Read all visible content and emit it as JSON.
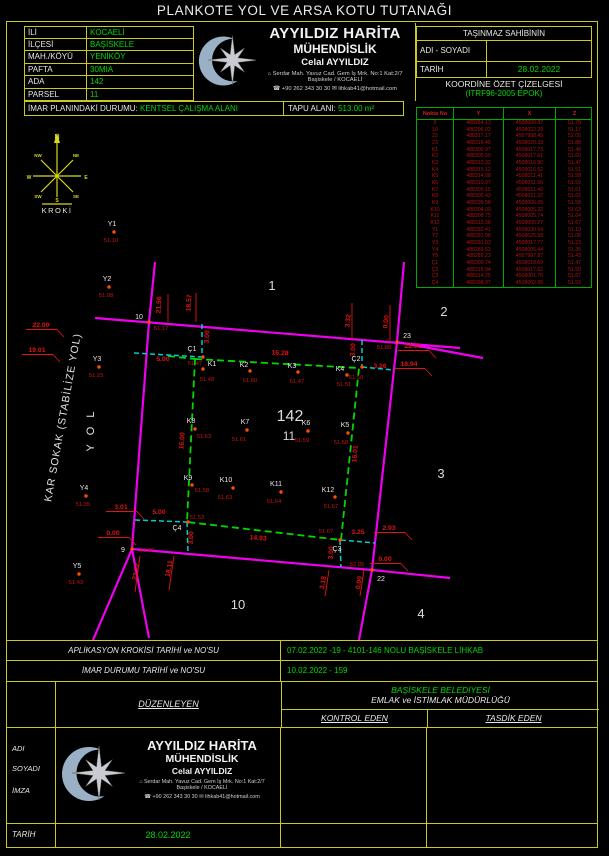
{
  "title": "PLANKOTE YOL VE ARSA KOTU TUTANAĞI",
  "parcel_info": {
    "rows": [
      {
        "label": "İLİ",
        "value": "KOCAELİ"
      },
      {
        "label": "İLÇESİ",
        "value": "BAŞİSKELE"
      },
      {
        "label": "MAH./KÖYÜ",
        "value": "YENİKÖY"
      },
      {
        "label": "PAFTA",
        "value": "30MIA"
      },
      {
        "label": "ADA",
        "value": "142"
      },
      {
        "label": "PARSEL",
        "value": "11"
      }
    ]
  },
  "company": {
    "line1": "AYYILDIZ HARİTA",
    "line2": "MÜHENDİSLİK",
    "line3": "Celal AYYILDIZ",
    "address1": "Serdar Mah. Yavuz Cad. Gem İş Mrk. No:1 Kat:2/7",
    "address2": "Başiskele / KOCAELİ",
    "phone": "+90 262 343 30 30",
    "email": "lihkab41@hotmail.com",
    "address_icon": "⌂",
    "phone_icon": "☎",
    "email_icon": "✉"
  },
  "owner_box": {
    "header": "TAŞINMAZ SAHİBİNİN",
    "name_label": "ADI - SOYADI",
    "name_value": "",
    "date_label": "TARİH",
    "date_value": "28.02.2022"
  },
  "imar": {
    "label": "İMAR PLANINDAKİ DURUMU:",
    "value": "KENTSEL ÇALIŞMA ALANI",
    "tapu_label": "TAPU ALANI:",
    "tapu_value": "513.00 m²"
  },
  "coord_table": {
    "title": "KOORDİNE ÖZET ÇİZELGESİ",
    "subtitle": "(ITRF96-2005 EPOK)",
    "headers": [
      "Nokta  No",
      "Y",
      "X",
      "Z"
    ],
    "rows": [
      [
        "9",
        "488284.13",
        "4508000.37",
        "51.78"
      ],
      [
        "10",
        "488296.02",
        "4508022.29",
        "51.17"
      ],
      [
        "22",
        "488317.17",
        "4507998.45",
        "52.05"
      ],
      [
        "23",
        "488319.49",
        "4508020.33",
        "51.88"
      ],
      [
        "K1",
        "488300.97",
        "4508017.73",
        "51.48"
      ],
      [
        "K2",
        "488305.60",
        "4508017.61",
        "51.60"
      ],
      [
        "K3",
        "488310.32",
        "4508016.80",
        "51.47"
      ],
      [
        "K4",
        "488315.12",
        "4508016.62",
        "51.51"
      ],
      [
        "K5",
        "488314.88",
        "4508011.41",
        "51.58"
      ],
      [
        "K6",
        "488310.97",
        "4508011.56",
        "51.59"
      ],
      [
        "K7",
        "488305.15",
        "4508011.49",
        "51.61"
      ],
      [
        "K8",
        "488300.43",
        "4508011.32",
        "51.63"
      ],
      [
        "K9",
        "488299.98",
        "4508006.05",
        "51.58"
      ],
      [
        "K10",
        "488304.09",
        "4508005.22",
        "51.63"
      ],
      [
        "K11",
        "488308.75",
        "4508005.74",
        "51.64"
      ],
      [
        "K12",
        "488313.38",
        "4508005.27",
        "51.67"
      ],
      [
        "Y1",
        "488292.41",
        "4508030.64",
        "51.10"
      ],
      [
        "Y2",
        "488291.98",
        "4508025.58",
        "51.08"
      ],
      [
        "Y3",
        "488291.03",
        "4508017.77",
        "51.23"
      ],
      [
        "Y4",
        "488289.62",
        "4508005.44",
        "51.35"
      ],
      [
        "Y5",
        "488289.23",
        "4507997.87",
        "51.43"
      ],
      [
        "Ç1",
        "488300.74",
        "4508018.69",
        "51.47"
      ],
      [
        "Ç2",
        "488315.94",
        "4508017.62",
        "51.50"
      ],
      [
        "Ç3",
        "488314.25",
        "4508001.70",
        "51.67"
      ],
      [
        "Ç4",
        "488298.37",
        "4508002.95",
        "51.53"
      ]
    ]
  },
  "map": {
    "colors": {
      "road": "#ee00ee",
      "boundary": "#00d800",
      "offset": "#00cccc",
      "dim": "#e01515",
      "point": "#ff4d00",
      "point_label": "#e8e8e8",
      "elev": "#c81414",
      "compass": "#d8d820"
    },
    "street1": "KAR SOKAK (STABİLİZE YOL)",
    "street2": "Y O L",
    "roads": [
      [
        [
          95,
          318
        ],
        [
          460,
          348
        ]
      ],
      [
        [
          397,
          342
        ],
        [
          483,
          358
        ]
      ],
      [
        [
          155,
          262
        ],
        [
          149,
          322
        ],
        [
          132,
          549
        ],
        [
          93,
          640
        ]
      ],
      [
        [
          404,
          262
        ],
        [
          397,
          342
        ],
        [
          372,
          570
        ],
        [
          359,
          640
        ]
      ],
      [
        [
          132,
          549
        ],
        [
          372,
          570
        ],
        [
          450,
          578
        ]
      ],
      [
        [
          132,
          549
        ],
        [
          149,
          638
        ]
      ]
    ],
    "boundary": [
      [
        195,
        359
      ],
      [
        359,
        368
      ],
      [
        341,
        540
      ],
      [
        187,
        522
      ]
    ],
    "boundary_ext": [
      [
        168,
        356
      ],
      [
        195,
        359
      ]
    ],
    "offsets": [
      [
        [
          134,
          353
        ],
        [
          202,
          357
        ]
      ],
      [
        [
          202,
          324
        ],
        [
          202,
          357
        ]
      ],
      [
        [
          362,
          340
        ],
        [
          362,
          367
        ]
      ],
      [
        [
          362,
          367
        ],
        [
          394,
          370
        ]
      ],
      [
        [
          340,
          540
        ],
        [
          341,
          567
        ]
      ],
      [
        [
          341,
          540
        ],
        [
          375,
          543
        ]
      ],
      [
        [
          135,
          520
        ],
        [
          187,
          522
        ]
      ],
      [
        [
          187,
          522
        ],
        [
          188,
          553
        ]
      ]
    ],
    "leaders": [
      [
        168,
        294,
        168,
        322
      ],
      [
        196,
        293,
        196,
        322
      ],
      [
        352,
        303,
        352,
        341
      ],
      [
        390,
        305,
        390,
        342
      ],
      [
        140,
        556,
        135,
        592
      ],
      [
        174,
        556,
        169,
        590
      ],
      [
        329,
        570,
        325,
        596
      ],
      [
        364,
        570,
        360,
        596
      ]
    ],
    "dims": [
      {
        "t": "22.00",
        "x": 41,
        "y": 327,
        "r": 0,
        "u": 1
      },
      {
        "t": "19.01",
        "x": 37,
        "y": 352,
        "r": 0,
        "u": 1
      },
      {
        "t": "21.56",
        "x": 161,
        "y": 305,
        "r": -87
      },
      {
        "t": "18.57",
        "x": 191,
        "y": 303,
        "r": -87
      },
      {
        "t": "3.00",
        "x": 209,
        "y": 337,
        "r": -87
      },
      {
        "t": "5.00",
        "x": 163,
        "y": 361,
        "r": 0
      },
      {
        "t": "16.28",
        "x": 280,
        "y": 355,
        "r": 3
      },
      {
        "t": "3.32",
        "x": 350,
        "y": 321,
        "r": -85
      },
      {
        "t": "0.00",
        "x": 388,
        "y": 322,
        "r": -85
      },
      {
        "t": "22.01",
        "x": 413,
        "y": 348,
        "r": 0,
        "u": 1
      },
      {
        "t": "18.94",
        "x": 409,
        "y": 366,
        "r": 0,
        "u": 1
      },
      {
        "t": "3.26",
        "x": 380,
        "y": 368,
        "r": 0
      },
      {
        "t": "3.00",
        "x": 355,
        "y": 350,
        "r": -87
      },
      {
        "t": "16.00",
        "x": 184,
        "y": 441,
        "r": -85
      },
      {
        "t": "16.01",
        "x": 357,
        "y": 454,
        "r": -85
      },
      {
        "t": "3.01",
        "x": 121,
        "y": 509,
        "r": 0,
        "u": 1
      },
      {
        "t": "5.00",
        "x": 159,
        "y": 514,
        "r": 0
      },
      {
        "t": "0.00",
        "x": 113,
        "y": 535,
        "r": 0,
        "u": 1
      },
      {
        "t": "3.00",
        "x": 193,
        "y": 538,
        "r": -87
      },
      {
        "t": "14.93",
        "x": 258,
        "y": 540,
        "r": 4
      },
      {
        "t": "3.25",
        "x": 358,
        "y": 534,
        "r": 0
      },
      {
        "t": "2.93",
        "x": 389,
        "y": 530,
        "r": 0,
        "u": 1
      },
      {
        "t": "3.00",
        "x": 333,
        "y": 553,
        "r": -87
      },
      {
        "t": "23.12",
        "x": 138,
        "y": 572,
        "r": -80
      },
      {
        "t": "18.11",
        "x": 171,
        "y": 569,
        "r": -80
      },
      {
        "t": "3.18",
        "x": 325,
        "y": 583,
        "r": -80
      },
      {
        "t": "0.00",
        "x": 361,
        "y": 583,
        "r": -80
      },
      {
        "t": "0.00",
        "x": 385,
        "y": 561,
        "r": 0,
        "u": 1
      }
    ],
    "points": [
      {
        "n": "9",
        "x": 132,
        "y": 549,
        "nx": 123,
        "ny": 552,
        "z": "51.78",
        "zx": 147,
        "zy": 552
      },
      {
        "n": "10",
        "x": 149,
        "y": 322,
        "nx": 139,
        "ny": 319,
        "z": "51.17",
        "zx": 161,
        "zy": 330
      },
      {
        "n": "22",
        "x": 372,
        "y": 570,
        "nx": 381,
        "ny": 581,
        "z": "52.05",
        "zx": 357,
        "zy": 566
      },
      {
        "n": "23",
        "x": 397,
        "y": 342,
        "nx": 407,
        "ny": 338,
        "z": "51.88",
        "zx": 384,
        "zy": 349
      },
      {
        "n": "K1",
        "x": 203,
        "y": 369,
        "nx": 212,
        "ny": 366,
        "z": "51.48",
        "zx": 207,
        "zy": 381
      },
      {
        "n": "K2",
        "x": 250,
        "y": 371,
        "nx": 244,
        "ny": 367,
        "z": "51.60",
        "zx": 250,
        "zy": 382
      },
      {
        "n": "K3",
        "x": 298,
        "y": 372,
        "nx": 292,
        "ny": 368,
        "z": "51.47",
        "zx": 297,
        "zy": 383
      },
      {
        "n": "K4",
        "x": 347,
        "y": 375,
        "nx": 340,
        "ny": 371,
        "z": "51.51",
        "zx": 344,
        "zy": 386
      },
      {
        "n": "K5",
        "x": 348,
        "y": 433,
        "nx": 345,
        "ny": 427,
        "z": "51.58",
        "zx": 341,
        "zy": 444
      },
      {
        "n": "K6",
        "x": 308,
        "y": 431,
        "nx": 306,
        "ny": 425,
        "z": "51.59",
        "zx": 302,
        "zy": 442
      },
      {
        "n": "K7",
        "x": 247,
        "y": 430,
        "nx": 245,
        "ny": 424,
        "z": "51.61",
        "zx": 239,
        "zy": 441
      },
      {
        "n": "K8",
        "x": 195,
        "y": 429,
        "nx": 191,
        "ny": 423,
        "z": "51.63",
        "zx": 204,
        "zy": 438
      },
      {
        "n": "K9",
        "x": 192,
        "y": 485,
        "nx": 188,
        "ny": 480,
        "z": "51.58",
        "zx": 202,
        "zy": 492
      },
      {
        "n": "K10",
        "x": 233,
        "y": 488,
        "nx": 226,
        "ny": 482,
        "z": "51.63",
        "zx": 225,
        "zy": 499
      },
      {
        "n": "K11",
        "x": 281,
        "y": 492,
        "nx": 276,
        "ny": 486,
        "z": "51.64",
        "zx": 274,
        "zy": 503
      },
      {
        "n": "K12",
        "x": 335,
        "y": 497,
        "nx": 328,
        "ny": 492,
        "z": "51.67",
        "zx": 331,
        "zy": 508
      },
      {
        "n": "Y1",
        "x": 114,
        "y": 232,
        "nx": 112,
        "ny": 226,
        "z": "51.10",
        "zx": 111,
        "zy": 242
      },
      {
        "n": "Y2",
        "x": 109,
        "y": 287,
        "nx": 107,
        "ny": 281,
        "z": "51.08",
        "zx": 106,
        "zy": 297
      },
      {
        "n": "Y3",
        "x": 99,
        "y": 367,
        "nx": 97,
        "ny": 361,
        "z": "51.23",
        "zx": 96,
        "zy": 377
      },
      {
        "n": "Y4",
        "x": 86,
        "y": 496,
        "nx": 84,
        "ny": 490,
        "z": "51.35",
        "zx": 83,
        "zy": 506
      },
      {
        "n": "Y5",
        "x": 79,
        "y": 574,
        "nx": 77,
        "ny": 568,
        "z": "51.43",
        "zx": 76,
        "zy": 584
      },
      {
        "n": "Ç1",
        "x": 203,
        "y": 357,
        "nx": 192,
        "ny": 351,
        "z": "51.47",
        "zx": 195,
        "zy": 365
      },
      {
        "n": "Ç2",
        "x": 362,
        "y": 367,
        "nx": 356,
        "ny": 361,
        "z": "51.50",
        "zx": 356,
        "zy": 379
      },
      {
        "n": "Ç3",
        "x": 340,
        "y": 540,
        "nx": 337,
        "ny": 551,
        "z": "51.67",
        "zx": 326,
        "zy": 533
      },
      {
        "n": "Ç4",
        "x": 188,
        "y": 522,
        "nx": 177,
        "ny": 530,
        "z": "51.53",
        "zx": 197,
        "zy": 519
      }
    ],
    "area_labels": [
      {
        "t": "1",
        "x": 272,
        "y": 290,
        "s": 13
      },
      {
        "t": "2",
        "x": 444,
        "y": 316,
        "s": 13
      },
      {
        "t": "3",
        "x": 441,
        "y": 478,
        "s": 13
      },
      {
        "t": "4",
        "x": 421,
        "y": 618,
        "s": 13
      },
      {
        "t": "10",
        "x": 238,
        "y": 609,
        "s": 13
      },
      {
        "t": "142",
        "x": 290,
        "y": 421,
        "s": 16
      },
      {
        "t": "11",
        "x": 289,
        "y": 440,
        "s": 12
      }
    ],
    "compass": {
      "lines": [
        [
          57,
          142,
          57,
          197
        ],
        [
          33,
          176,
          81,
          176
        ],
        [
          41,
          160,
          73,
          192
        ],
        [
          73,
          160,
          41,
          192
        ],
        [
          42,
          204,
          72,
          204
        ]
      ],
      "arrow": "57,133 54,143 60,143",
      "letters": [
        {
          "t": "N",
          "x": 57,
          "y": 139,
          "s": 7
        },
        {
          "t": "S",
          "x": 57,
          "y": 202,
          "s": 5
        },
        {
          "t": "W",
          "x": 29,
          "y": 179,
          "s": 5
        },
        {
          "t": "E",
          "x": 86,
          "y": 179,
          "s": 5
        },
        {
          "t": "NW",
          "x": 38,
          "y": 157,
          "s": 4.5
        },
        {
          "t": "NE",
          "x": 76,
          "y": 157,
          "s": 4.5
        },
        {
          "t": "SW",
          "x": 38,
          "y": 198,
          "s": 4.5
        },
        {
          "t": "SE",
          "x": 76,
          "y": 198,
          "s": 4.5
        }
      ],
      "label": "KROKİ",
      "label_x": 57,
      "label_y": 213
    }
  },
  "footer": {
    "rows": [
      {
        "label": "APLİKASYON KROKİSİ TARİHİ ve NO'SU",
        "value": "07.02.2022 -19 - 4101-146 NOLU BAŞİSKELE LİHKAB"
      },
      {
        "label": "İMAR DURUMU TARİHİ ve NO'SU",
        "value": "10.02.2022 - 159"
      }
    ],
    "duzenleyen": "DÜZENLEYEN",
    "belediye1": "BAŞİSKELE BELEDİYESİ",
    "belediye2": "EMLAK ve İSTİMLAK MÜDÜRLÜĞÜ",
    "kontrol": "KONTROL EDEN",
    "tasdik": "TASDİK EDEN",
    "adi": "ADI",
    "soyadi": "SOYADI",
    "imza": "İMZA",
    "tarih_label": "TARİH",
    "tarih_value": "28.02.2022"
  }
}
